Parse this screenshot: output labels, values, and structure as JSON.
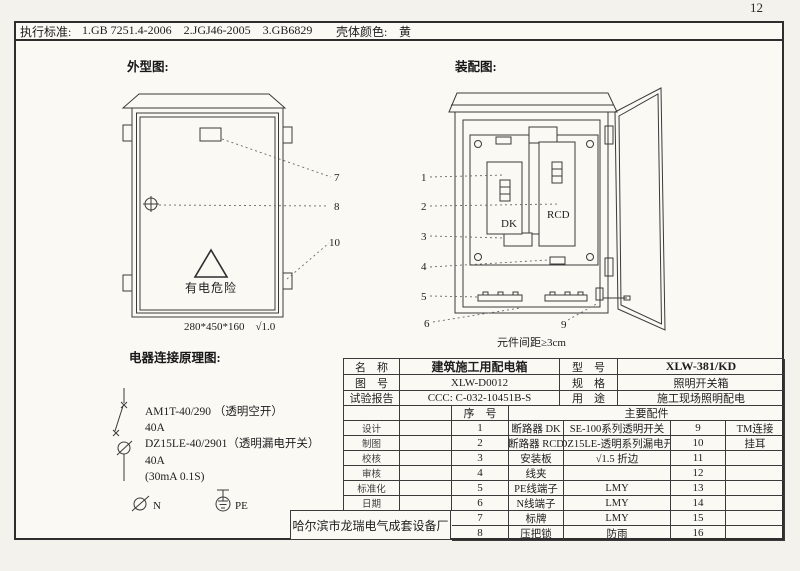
{
  "page": {
    "number": "12"
  },
  "strip": {
    "standards_label": "执行标准:",
    "standards": "1.GB 7251.4-2006    2.JGJ46-2005    3.GB6829",
    "color_label": "壳体颜色:",
    "color": "黄"
  },
  "outline": {
    "title": "外型图:",
    "warning": "有电危险",
    "dims": "280*450*160　√1.0",
    "callouts": [
      "7",
      "8",
      "10"
    ]
  },
  "assembly": {
    "title": "装配图:",
    "dk": "DK",
    "rcd": "RCD",
    "gap_note": "元件间距≥3cm",
    "callouts": [
      "1",
      "2",
      "3",
      "4",
      "5",
      "6",
      "9"
    ]
  },
  "schematic": {
    "title": "电器连接原理图:",
    "b1_model": "AM1T-40/290 （透明空开）",
    "b1_rating": "40A",
    "b2_model": "DZ15LE-40/2901（透明漏电开关）",
    "b2_rating": "40A",
    "b2_params": "(30mA 0.1S)",
    "n": "N",
    "pe": "PE"
  },
  "table": {
    "info": {
      "name_label": "名　称",
      "name": "建筑施工用配电箱",
      "model_label": "型　号",
      "model": "XLW-381/KD",
      "dwg_label": "图　号",
      "dwg": "XLW-D0012",
      "spec_label": "规　格",
      "spec": "照明开关箱",
      "test_label": "试验报告",
      "test": "CCC: C-032-10451B-S",
      "use_label": "用　途",
      "use": "施工现场照明配电"
    },
    "seq_header": "序　号",
    "parts_header": "主要配件",
    "signatures": [
      "设计",
      "制图",
      "校核",
      "审核",
      "标准化",
      "日期"
    ],
    "parts": [
      {
        "no": "1",
        "name": "断路器 DK",
        "spec": "SE-100系列透明开关",
        "no2": "9",
        "spec2": "TM连接"
      },
      {
        "no": "2",
        "name": "断路器 RCD",
        "spec": "DZ15LE-透明系列漏电开",
        "no2": "10",
        "spec2": "挂耳"
      },
      {
        "no": "3",
        "name": "安装板",
        "spec": "√1.5 折边",
        "no2": "11",
        "spec2": ""
      },
      {
        "no": "4",
        "name": "线夹",
        "spec": "",
        "no2": "12",
        "spec2": ""
      },
      {
        "no": "5",
        "name": "PE线端子",
        "spec": "LMY",
        "no2": "13",
        "spec2": ""
      },
      {
        "no": "6",
        "name": "N线端子",
        "spec": "LMY",
        "no2": "14",
        "spec2": ""
      },
      {
        "no": "7",
        "name": "标牌",
        "spec": "LMY",
        "no2": "15",
        "spec2": ""
      },
      {
        "no": "8",
        "name": "压把锁",
        "spec": "防雨",
        "no2": "16",
        "spec2": ""
      }
    ]
  },
  "footer": {
    "manufacturer": "哈尔滨市龙瑞电气成套设备厂"
  }
}
